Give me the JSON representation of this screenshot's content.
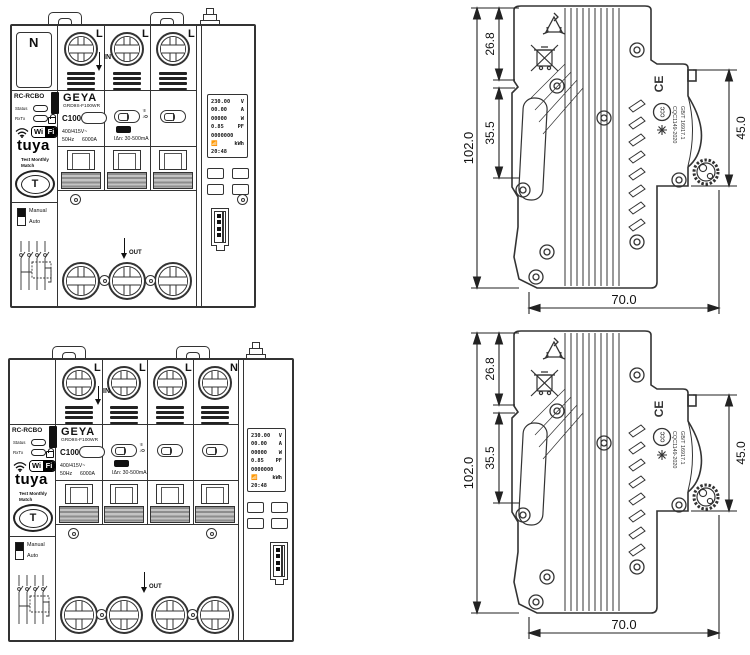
{
  "front": {
    "brand": "GEYA",
    "model": "GRD9S-F100WR",
    "type_label": "RC-RCBO",
    "rating": "C100",
    "voltage": "400/415V~",
    "freq": "50Hz",
    "breaking": "6000A",
    "leakage": "IΔn: 30-500mA",
    "status": "Status",
    "rxtx": "RxTx",
    "wifi": "WiFi",
    "tuya": "tuya",
    "test_line1": "Test Monthly",
    "test_line2": "Match",
    "test_button": "T",
    "manual": "Manual",
    "auto": "Auto",
    "in_label": "IN",
    "out_label": "OUT",
    "io_on": "↑I",
    "io_off": "↓O",
    "lcd_rows": [
      {
        "value": "230.00",
        "unit": "V"
      },
      {
        "value": "00.00",
        "unit": "A"
      },
      {
        "value": "00000",
        "unit": "W"
      },
      {
        "value": "0.85",
        "unit": "PF"
      },
      {
        "value": "0000000",
        "unit": ""
      },
      {
        "value": "",
        "unit": "kWh"
      },
      {
        "value": "20:48",
        "unit": ""
      }
    ]
  },
  "front_top": {
    "poles": [
      "L",
      "L",
      "L"
    ],
    "neutral": "N"
  },
  "front_bottom": {
    "poles": [
      "L",
      "L",
      "L",
      "N"
    ]
  },
  "side": {
    "dim_overall_height": "102.0",
    "dim_top_section": "26.8",
    "dim_mid_section": "35.5",
    "dim_front_height": "45.0",
    "dim_width": "70.0",
    "ce": "CE",
    "ccc": "CCC",
    "cert_line1": "CQC1149-2020",
    "cert_line2": "GB/T 16917.1"
  }
}
